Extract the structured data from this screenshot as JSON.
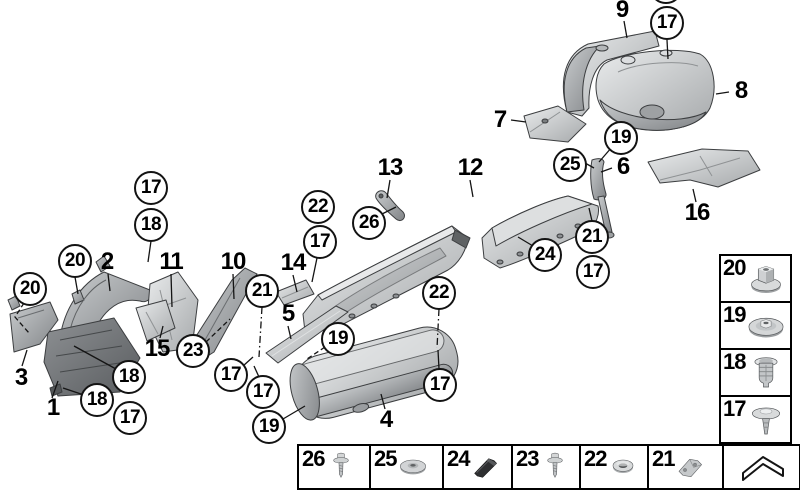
{
  "colors": {
    "background": "#ffffff",
    "line": "#141414",
    "part_light": "#e8eaeb",
    "part_mid": "#c4c7c9",
    "part_dark": "#8a8d90"
  },
  "diagram": {
    "part_labels": [
      {
        "label": "1",
        "x": 53,
        "y": 408
      },
      {
        "label": "2",
        "x": 107,
        "y": 262
      },
      {
        "label": "3",
        "x": 21,
        "y": 378
      },
      {
        "label": "4",
        "x": 386,
        "y": 420
      },
      {
        "label": "5",
        "x": 288,
        "y": 314
      },
      {
        "label": "6",
        "x": 623,
        "y": 167
      },
      {
        "label": "7",
        "x": 500,
        "y": 120
      },
      {
        "label": "8",
        "x": 741,
        "y": 91
      },
      {
        "label": "9",
        "x": 622,
        "y": 10
      },
      {
        "label": "10",
        "x": 233,
        "y": 262
      },
      {
        "label": "11",
        "x": 171,
        "y": 262
      },
      {
        "label": "12",
        "x": 470,
        "y": 168
      },
      {
        "label": "13",
        "x": 390,
        "y": 168
      },
      {
        "label": "14",
        "x": 293,
        "y": 263
      },
      {
        "label": "15",
        "x": 157,
        "y": 349
      },
      {
        "label": "16",
        "x": 697,
        "y": 213
      }
    ],
    "callouts": [
      {
        "label": "17",
        "x": 151,
        "y": 188
      },
      {
        "label": "18",
        "x": 151,
        "y": 225
      },
      {
        "label": "20",
        "x": 75,
        "y": 261
      },
      {
        "label": "20",
        "x": 30,
        "y": 289
      },
      {
        "label": "22",
        "x": 318,
        "y": 207
      },
      {
        "label": "26",
        "x": 369,
        "y": 223
      },
      {
        "label": "17",
        "x": 320,
        "y": 242
      },
      {
        "label": "21",
        "x": 262,
        "y": 291
      },
      {
        "label": "23",
        "x": 193,
        "y": 351
      },
      {
        "label": "18",
        "x": 129,
        "y": 377
      },
      {
        "label": "18",
        "x": 97,
        "y": 400
      },
      {
        "label": "17",
        "x": 130,
        "y": 418
      },
      {
        "label": "17",
        "x": 231,
        "y": 375
      },
      {
        "label": "17",
        "x": 263,
        "y": 392
      },
      {
        "label": "19",
        "x": 269,
        "y": 427
      },
      {
        "label": "19",
        "x": 338,
        "y": 339
      },
      {
        "label": "22",
        "x": 439,
        "y": 293
      },
      {
        "label": "17",
        "x": 440,
        "y": 385
      },
      {
        "label": "24",
        "x": 545,
        "y": 255
      },
      {
        "label": "21",
        "x": 592,
        "y": 237
      },
      {
        "label": "17",
        "x": 593,
        "y": 272
      },
      {
        "label": "25",
        "x": 570,
        "y": 165
      },
      {
        "label": "19",
        "x": 621,
        "y": 138
      },
      {
        "label": "17",
        "x": 667,
        "y": 23
      },
      {
        "label": "",
        "x": 666,
        "y": -13
      }
    ]
  },
  "legend": {
    "items": [
      {
        "label": "20",
        "icon": "hex-flange-nut"
      },
      {
        "label": "19",
        "icon": "disc-nut"
      },
      {
        "label": "18",
        "icon": "expansion-rivet"
      },
      {
        "label": "17",
        "icon": "push-rivet"
      }
    ]
  },
  "bottom_strip": {
    "items": [
      {
        "label": "26",
        "icon": "screw"
      },
      {
        "label": "25",
        "icon": "washer-disc"
      },
      {
        "label": "24",
        "icon": "rubber-block"
      },
      {
        "label": "23",
        "icon": "screw"
      },
      {
        "label": "22",
        "icon": "grommet"
      },
      {
        "label": "21",
        "icon": "clip-bracket"
      }
    ],
    "continue_icon": "continue-arrow"
  }
}
